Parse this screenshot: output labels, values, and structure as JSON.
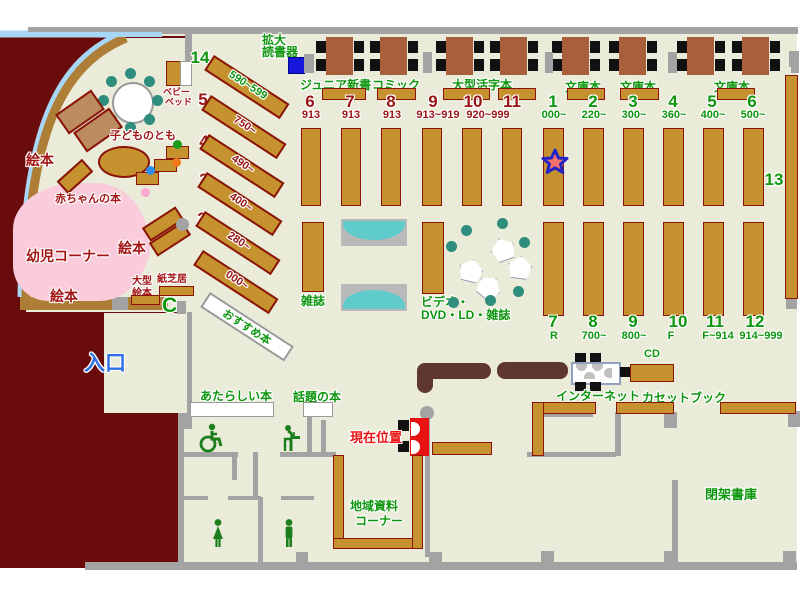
{
  "colors": {
    "floor": "#EBEBDA",
    "outside_wall": "#6B0C0C",
    "shelf": "#C6922F",
    "green_text": "#0E960E",
    "red_text": "#A21414",
    "blue_text": "#2F6FE6",
    "pink_area": "#F9CBDB",
    "teal_chair": "#2E8D7D",
    "star_fill": "#F4726B",
    "star_border": "#2224C6"
  },
  "children": {
    "ehon1": "絵本",
    "ehon2": "絵本",
    "ehon3": "絵本",
    "kodomo_no_tomo": "子どものとも",
    "akachan_no_hon": "赤ちゃんの本",
    "yoji_corner": "幼児コーナー",
    "baby_bed": [
      "ベビー",
      "ベッド"
    ],
    "ogata_ehon": [
      "大型",
      "絵本"
    ],
    "kamishibai": "紙芝居",
    "phone": "C"
  },
  "entrance": "入口",
  "devices": {
    "kakudai": [
      "拡大",
      "読書器"
    ]
  },
  "top_labels": {
    "junior": "ジュニア新書",
    "comic": "コミック",
    "ogata_katsuji": "大型活字本",
    "bunko_a": "文庫本",
    "bunko_b": "文庫本",
    "bunko_c": "文庫本"
  },
  "diagonal": [
    {
      "no": "14",
      "range": "590~599"
    },
    {
      "no": "5",
      "range": "750~"
    },
    {
      "no": "4",
      "range": "490~"
    },
    {
      "no": "3",
      "range": "400~"
    },
    {
      "no": "2",
      "range": "280~"
    },
    {
      "no": "1",
      "range": "000~"
    }
  ],
  "osusume": "おすすめ本",
  "upper_left": {
    "nos": [
      "6",
      "7",
      "8",
      "9",
      "10",
      "11"
    ],
    "codes": [
      "913",
      "913",
      "913",
      "913~919",
      "920~999"
    ]
  },
  "upper_right": {
    "nos": [
      "1",
      "2",
      "3",
      "4",
      "5",
      "6"
    ],
    "codes": [
      "000~",
      "220~",
      "300~",
      "360~",
      "400~",
      "500~"
    ]
  },
  "lower": {
    "nos": [
      "7",
      "8",
      "9",
      "10",
      "11",
      "12"
    ],
    "codes": [
      "R",
      "700~",
      "800~",
      "F",
      "F~914",
      "914~999"
    ]
  },
  "s13": "13",
  "zasshi": "雑誌",
  "video": [
    "ビデオ・",
    "DVD・LD・雑誌"
  ],
  "mid": {
    "atarashii": "あたらしい本",
    "wadai": "話題の本",
    "genzai": "現在位置",
    "internet": "インターネット",
    "cd": "CD",
    "cassette": "カセットブック"
  },
  "rooms": {
    "chiiki": [
      "地域資料",
      "コーナー"
    ],
    "heika": "閉架書庫"
  }
}
